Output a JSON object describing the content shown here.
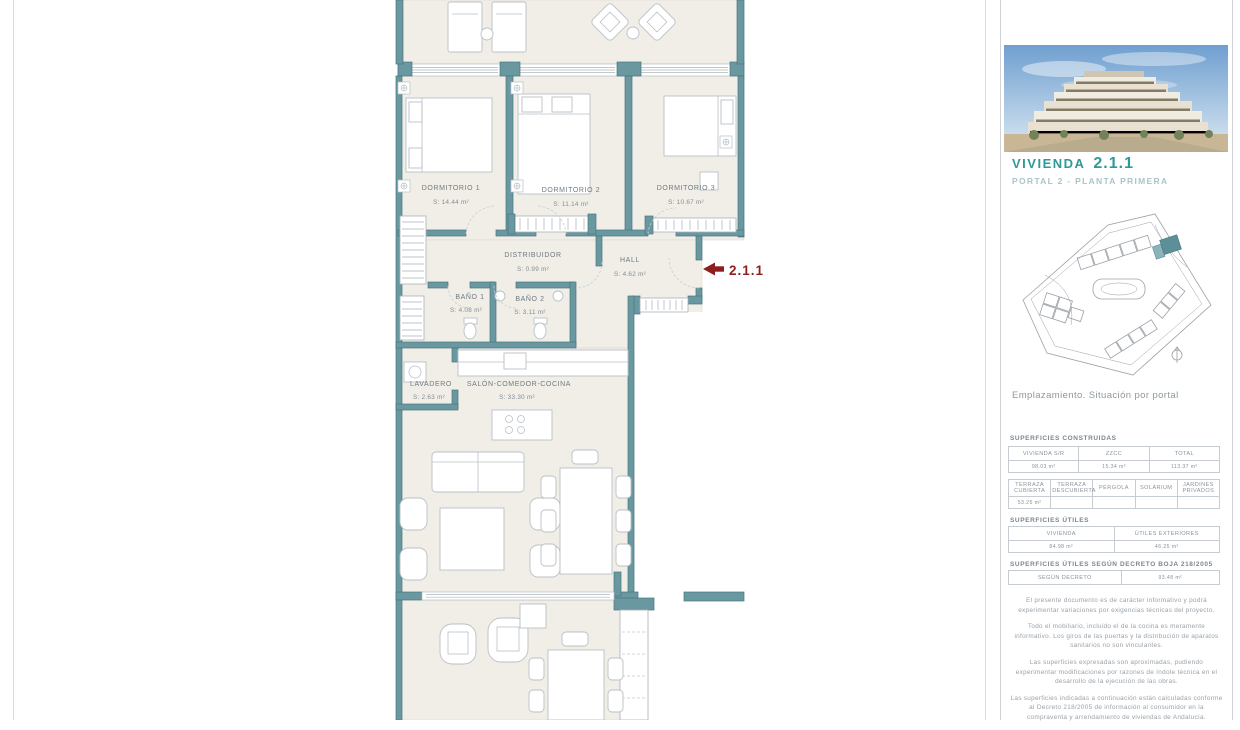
{
  "plan": {
    "unit_tag": "2.1.1",
    "rooms": [
      {
        "name": "DORMITORIO 1",
        "area": "S: 14.44 m²"
      },
      {
        "name": "DORMITORIO 2",
        "area": "S: 11.14 m²"
      },
      {
        "name": "DORMITORIO 3",
        "area": "S: 10.67 m²"
      },
      {
        "name": "DISTRIBUIDOR",
        "area": "S: 0.99 m²"
      },
      {
        "name": "HALL",
        "area": "S: 4.62 m²"
      },
      {
        "name": "BAÑO 1",
        "area": "S: 4.08 m²"
      },
      {
        "name": "BAÑO 2",
        "area": "S: 3.11 m²"
      },
      {
        "name": "LAVADERO",
        "area": "S: 2.63 m²"
      },
      {
        "name": "SALÓN-COMEDOR-COCINA",
        "area": "S: 33.30 m²"
      }
    ],
    "colors": {
      "wall": "#6a98a1",
      "floor": "#f1ede7",
      "accent": "#8e1f1f"
    }
  },
  "sidebar": {
    "title": "VIVIENDA",
    "title_number": "2.1.1",
    "subtitle": "PORTAL 2 - PLANTA PRIMERA",
    "siteplan_caption": "Emplazamiento. Situación por portal",
    "accent_color": "#2f9898",
    "sections": [
      {
        "heading": "SUPERFICIES CONSTRUIDAS",
        "tables": [
          {
            "headers": [
              "VIVIENDA S/R",
              "ZZCC",
              "TOTAL"
            ],
            "values": [
              "98.03 m²",
              "15.34 m²",
              "113.37 m²"
            ]
          },
          {
            "headers": [
              "TERRAZA CUBIERTA",
              "TERRAZA DESCUBIERTA",
              "PÉRGOLA",
              "SOLÁRIUM",
              "JARDINES PRIVADOS"
            ],
            "values": [
              "53.25 m²",
              "",
              "",
              "",
              ""
            ]
          }
        ]
      },
      {
        "heading": "SUPERFICIES ÚTILES",
        "tables": [
          {
            "headers": [
              "VIVIENDA",
              "ÚTILES EXTERIORES"
            ],
            "values": [
              "84.98 m²",
              "46.25 m²"
            ]
          }
        ]
      },
      {
        "heading": "SUPERFICIES ÚTILES SEGÚN DECRETO BOJA 218/2005",
        "tables": [
          {
            "headers": [
              "SEGÚN DECRETO"
            ],
            "values": [
              "93.48 m²"
            ]
          }
        ]
      }
    ],
    "disclaimers": [
      "El presente documento es de carácter informativo y podrá experimentar variaciones por exigencias técnicas del proyecto.",
      "Todo el mobiliario, incluido el de la cocina es meramente informativo. Los giros de las puertas y la distribución de aparatos sanitarios no son vinculantes.",
      "Las superficies expresadas son aproximadas, pudiendo experimentar modificaciones por razones de índole técnica en el desarrollo de la ejecución de las obras.",
      "Las superficies indicadas a continuación están calculadas conforme al Decreto 218/2005 de información al consumidor en la compraventa y arrendamiento de viviendas de Andalucía."
    ]
  }
}
